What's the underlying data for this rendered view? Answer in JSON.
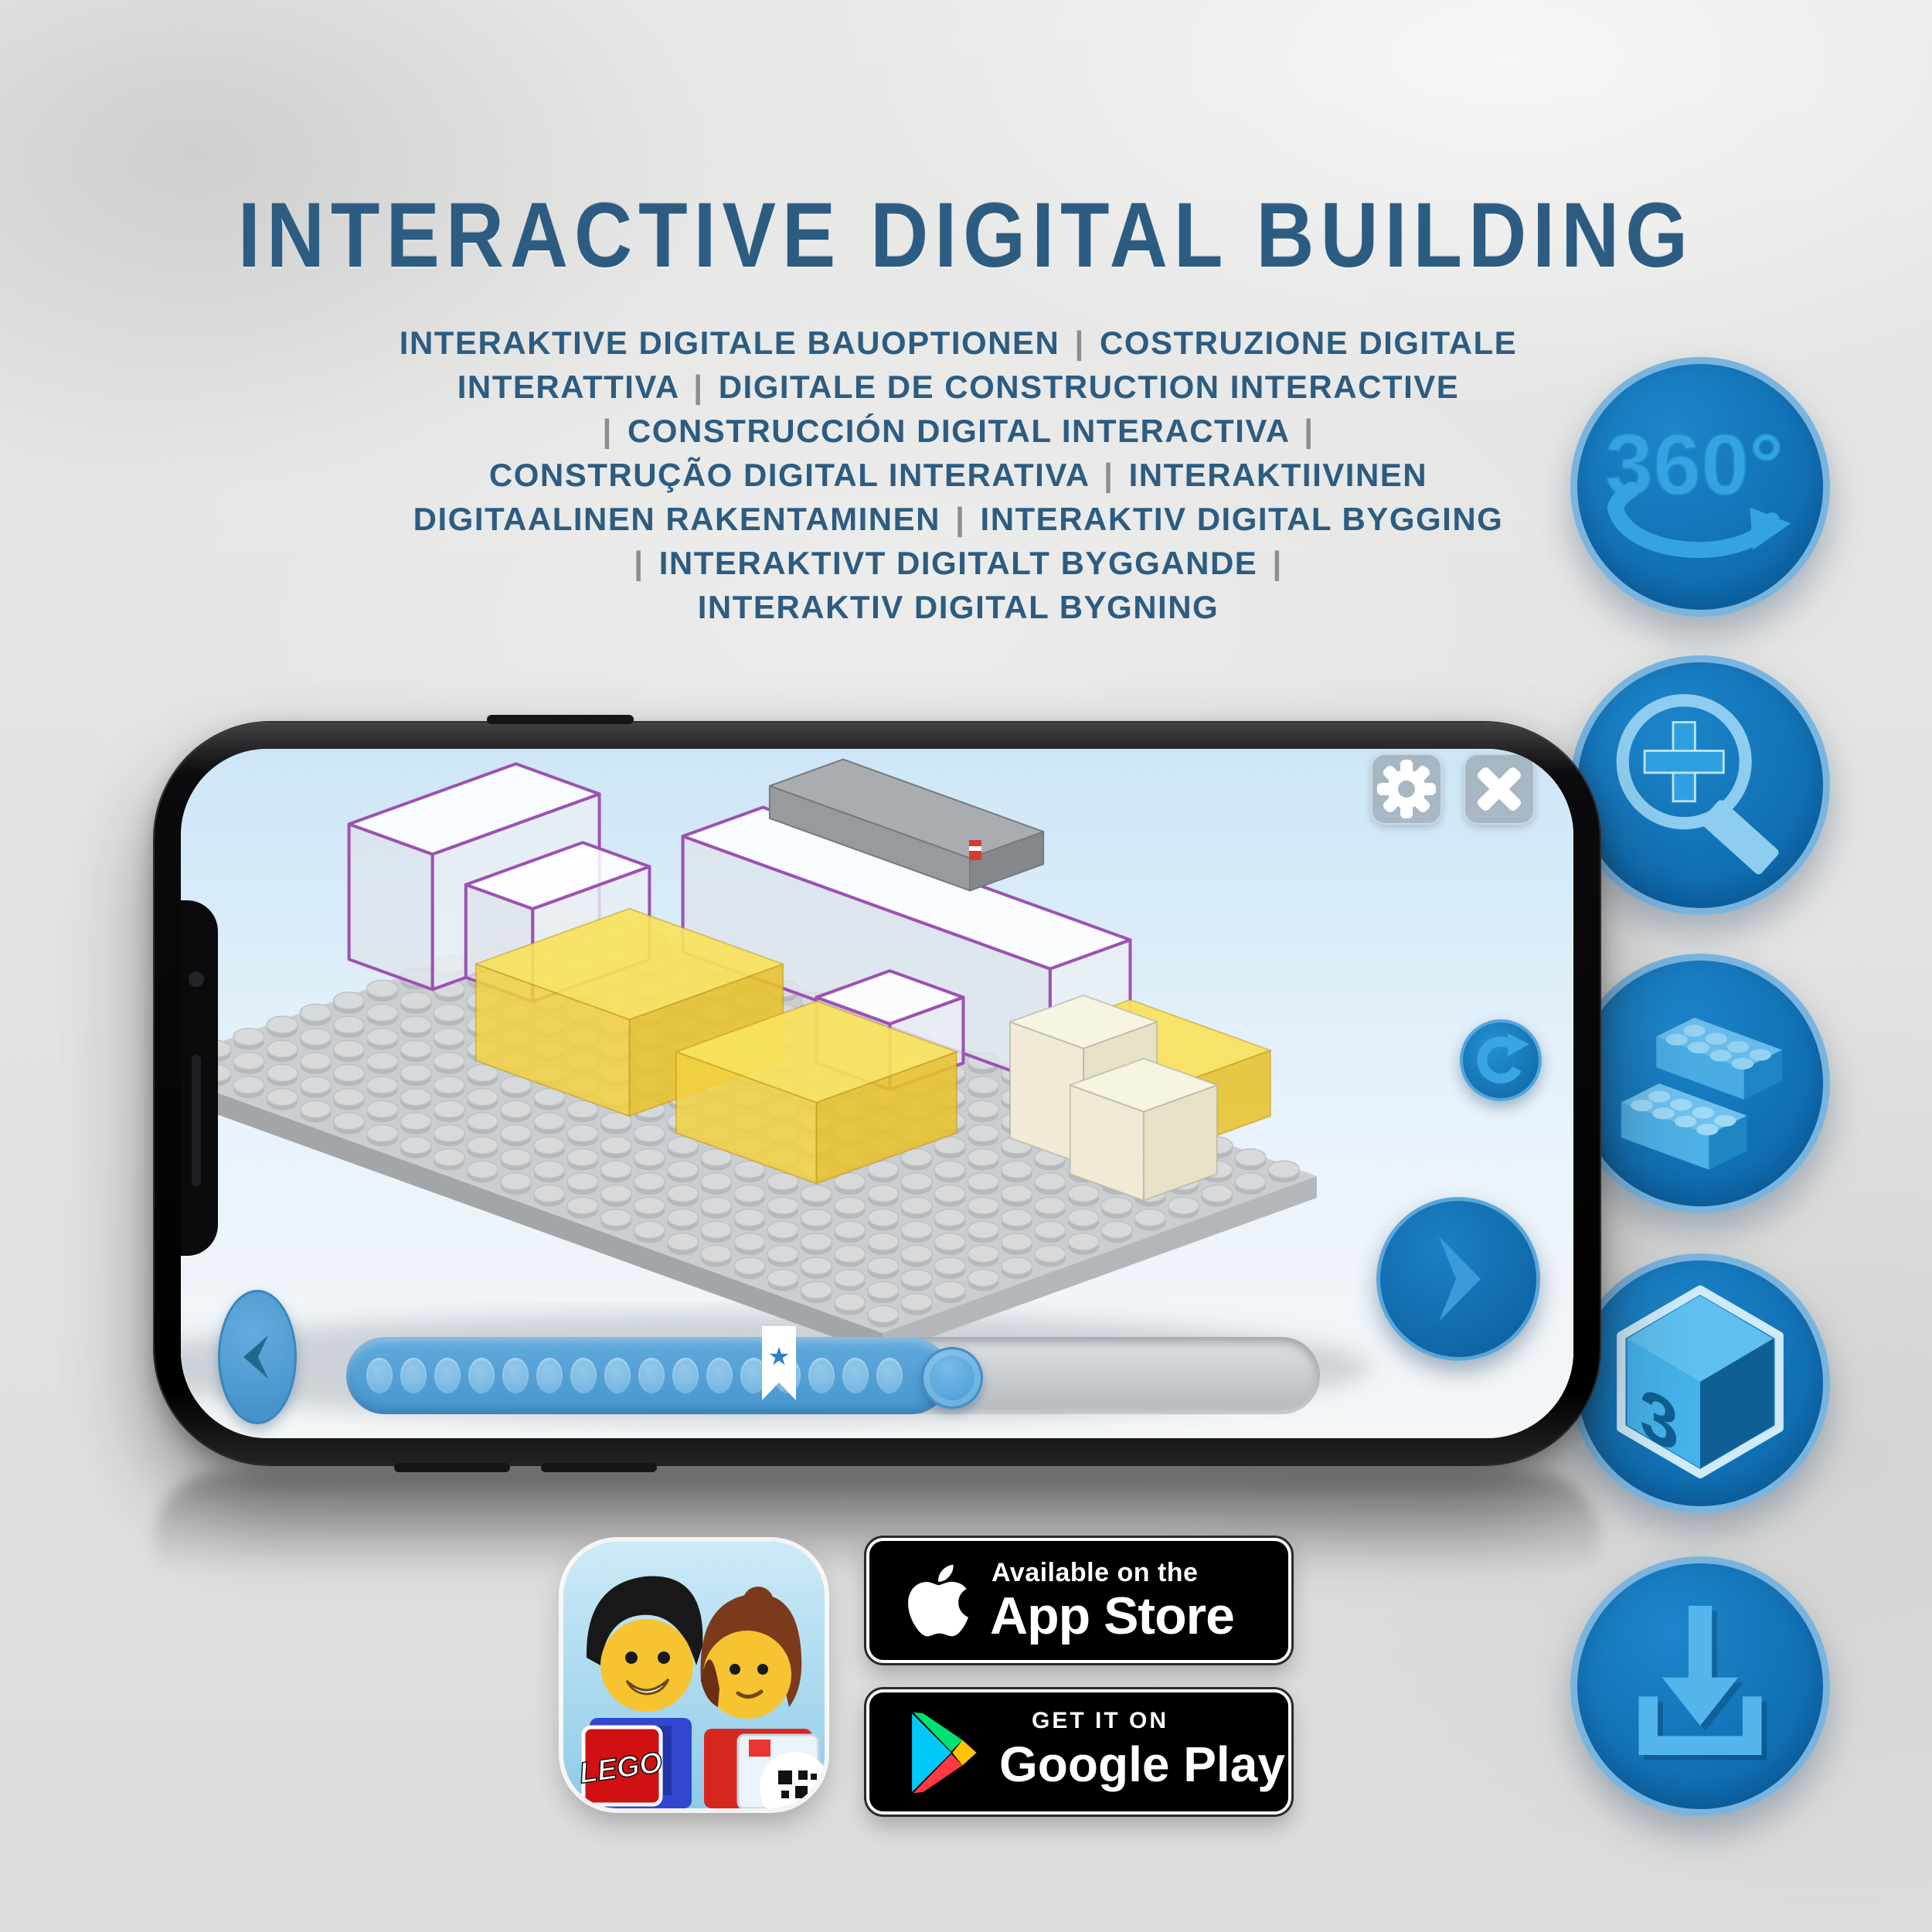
{
  "page_title": "INTERACTIVE DIGITAL BUILDING",
  "subtitle_lines": [
    "INTERAKTIVE DIGITALE BAUOPTIONEN | COSTRUZIONE DIGITALE",
    "INTERATTIVA | DIGITALE DE CONSTRUCTION INTERACTIVE",
    "| CONSTRUCCIÓN DIGITAL INTERACTIVA |",
    "CONSTRUÇÃO DIGITAL INTERATIVA | INTERAKTIIVINEN",
    "DIGITAALINEN RAKENTAMINEN | INTERAKTIV DIGITAL BYGGING",
    "| INTERAKTIVT DIGITALT BYGGANDE |",
    "INTERAKTIV DIGITAL BYGNING"
  ],
  "feature_icons": [
    {
      "id": "rotate-360",
      "label": "360°"
    },
    {
      "id": "zoom-in",
      "label": ""
    },
    {
      "id": "lego-bricks",
      "label": ""
    },
    {
      "id": "3d-view",
      "left": "3",
      "right": "D"
    },
    {
      "id": "download",
      "label": ""
    }
  ],
  "phone": {
    "app_ui": {
      "settings_button": "settings",
      "close_button": "close",
      "rotate_button": "rotate-model",
      "next_button": "next-step",
      "back_button": "previous-step",
      "progress": {
        "dot_count": 16,
        "filled_percent": 62,
        "bookmark_percent": 44,
        "bookmark_icon": "★"
      }
    }
  },
  "badges": {
    "app_icon_label": "LEGO",
    "app_store": {
      "line1": "Available on the",
      "line2": "App Store"
    },
    "google_play": {
      "line1": "GET IT ON",
      "line2": "Google Play"
    }
  },
  "colors": {
    "title_blue": "#2c5c81",
    "separator_grey": "#8d8d8d",
    "icon_circle_blue": "#1173b8",
    "icon_ring_blue": "#79b4de",
    "icon_glyph_blue": "#35a3e2",
    "progress_blue": "#4f9fd7",
    "brick_yellow": "#f2d141",
    "outline_purple": "#9c52b2"
  }
}
